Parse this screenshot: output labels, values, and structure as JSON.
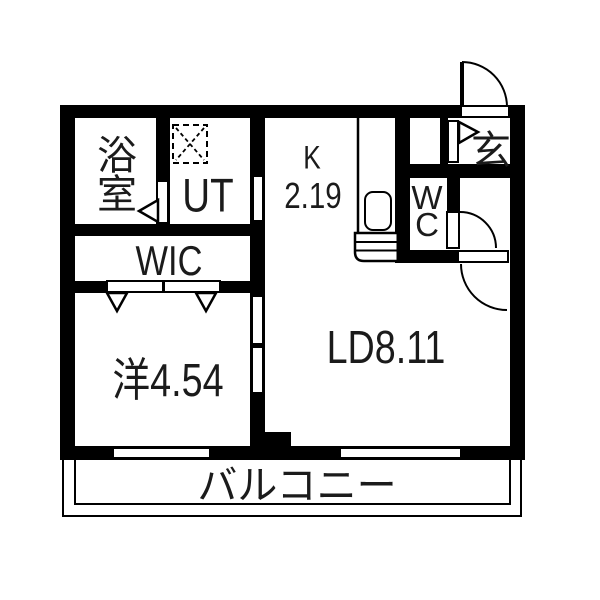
{
  "title": "apartment-floor-plan",
  "colors": {
    "wall": "#000000",
    "bg": "#ffffff",
    "text": "#1b1b1b"
  },
  "rooms": {
    "bathroom": {
      "chars": [
        "浴",
        "室"
      ]
    },
    "utility": {
      "label": "UT"
    },
    "kitchen": {
      "label": "K",
      "area": "2.19"
    },
    "entrance": {
      "label": "玄"
    },
    "toilet": {
      "chars": [
        "W",
        "C"
      ]
    },
    "closet": {
      "label": "WIC"
    },
    "bedroom": {
      "label": "洋4.54"
    },
    "living": {
      "label": "LD8.11"
    },
    "balcony": {
      "label": "バルコニー"
    }
  }
}
